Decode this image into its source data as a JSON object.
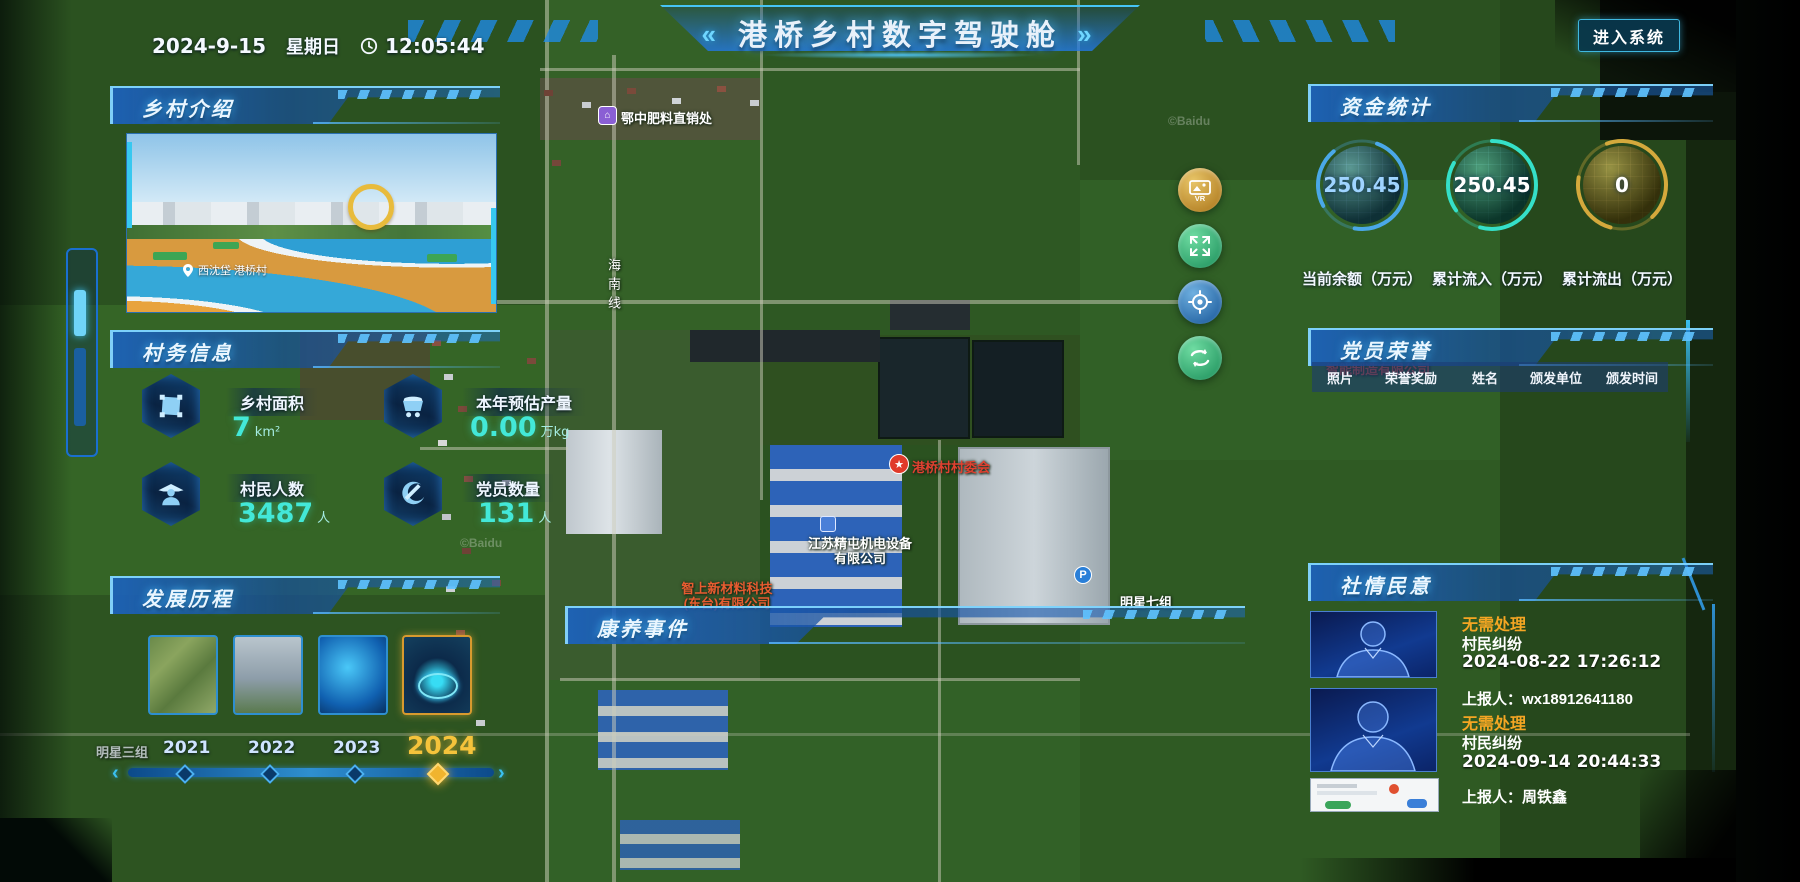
{
  "header": {
    "date": "2024-9-15",
    "weekday": "星期日",
    "time": "12:05:44",
    "title": "港桥乡村数字驾驶舱",
    "left_chevron": "«",
    "right_chevron": "»",
    "enter_button": "进入系统"
  },
  "village_intro": {
    "title": "乡村介绍",
    "photo_caption": "西沈垈 港桥村"
  },
  "village_info": {
    "title": "村务信息",
    "stats": [
      {
        "icon": "area-icon",
        "label": "乡村面积",
        "value": "7",
        "unit": "km²"
      },
      {
        "icon": "cart-icon",
        "label": "本年预估产量",
        "value": "0.00",
        "unit": "万kg"
      },
      {
        "icon": "villager-icon",
        "label": "村民人数",
        "value": "3487",
        "unit": "人"
      },
      {
        "icon": "party-emblem-icon",
        "label": "党员数量",
        "value": "131",
        "unit": "人"
      }
    ]
  },
  "development": {
    "title": "发展历程",
    "years": [
      "2021",
      "2022",
      "2023",
      "2024"
    ],
    "selected_year": "2024",
    "prev_arrow": "‹",
    "next_arrow": "›"
  },
  "funds": {
    "title": "资金统计",
    "gauges": [
      {
        "value": "250.45",
        "label": "当前余额（万元）",
        "color": "#4aa8e8"
      },
      {
        "value": "250.45",
        "label": "累计流入（万元）",
        "color": "#35e0c9"
      },
      {
        "value": "0",
        "label": "累计流出（万元）",
        "color": "#d4a93c"
      }
    ]
  },
  "party_honor": {
    "title": "党员荣誉",
    "columns": [
      "照片",
      "荣誉奖励",
      "姓名",
      "颁发单位",
      "颁发时间"
    ]
  },
  "sentiment": {
    "title": "社情民意",
    "items": [
      {
        "status": "无需处理",
        "type": "村民纠纷",
        "time": "2024-08-22 17:26:12",
        "reporter": "上报人：wx18912641180"
      },
      {
        "status": "无需处理",
        "type": "村民纠纷",
        "time": "2024-09-14 20:44:33",
        "reporter": "上报人：周铁鑫"
      }
    ]
  },
  "wellness": {
    "title": "康养事件"
  },
  "map": {
    "watermark": "©Baidu",
    "vr_label": "VR",
    "labels": {
      "fertilizer": "鄂中肥料直销处",
      "road": "海南线",
      "committee": "港桥村村委会",
      "company1_line1": "江苏精屯机电设备",
      "company1_line2": "有限公司",
      "company2_line1": "智上新材料科技",
      "company2_line2": "(东台)有限公司",
      "company3": "智能制造有限公司",
      "group7": "明星七组",
      "group3": "明星三组",
      "parking": "P"
    },
    "accent_cyan": "#3ac0f0",
    "accent_gold": "#f0b42e"
  }
}
